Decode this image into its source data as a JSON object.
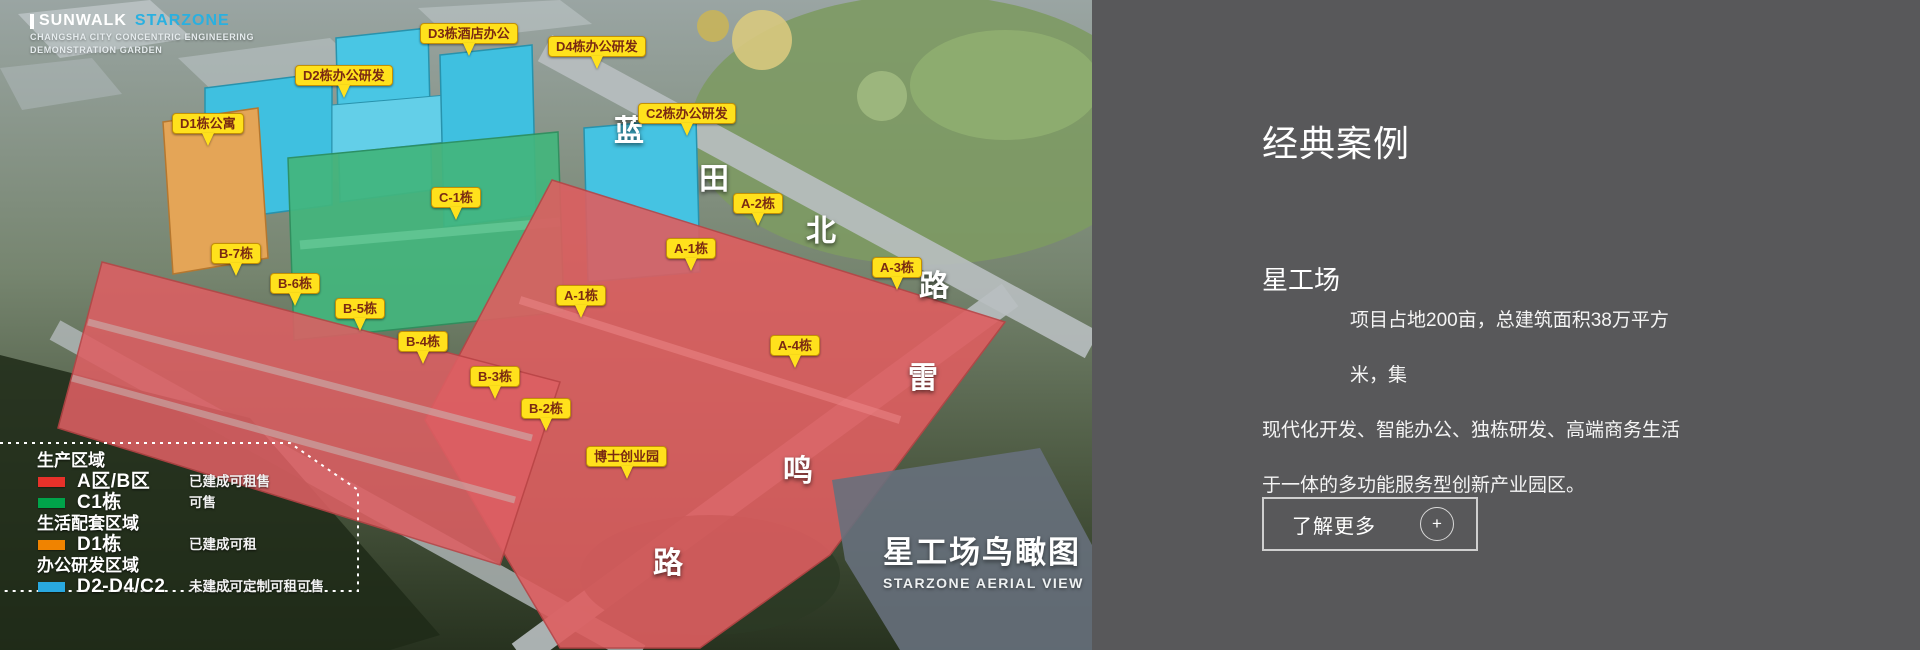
{
  "logo": {
    "brand_primary": "SUNWALK",
    "brand_secondary": "STARZONE",
    "subtitle_line1": "CHANGSHA CITY CONCENTRIC ENGINEERING",
    "subtitle_line2": "DEMONSTRATION GARDEN"
  },
  "aerial": {
    "building_labels": [
      {
        "text": "D1栋公寓"
      },
      {
        "text": "D2栋办公研发"
      },
      {
        "text": "D3栋酒店办公"
      },
      {
        "text": "D4栋办公研发"
      },
      {
        "text": "C2栋办公研发"
      },
      {
        "text": "C-1栋"
      },
      {
        "text": "A-2栋"
      },
      {
        "text": "A-1栋"
      },
      {
        "text": "A-3栋"
      },
      {
        "text": "A-1栋"
      },
      {
        "text": "A-4栋"
      },
      {
        "text": "B-7栋"
      },
      {
        "text": "B-6栋"
      },
      {
        "text": "B-5栋"
      },
      {
        "text": "B-4栋"
      },
      {
        "text": "B-3栋"
      },
      {
        "text": "B-2栋"
      },
      {
        "text": "博士创业园"
      }
    ],
    "road_labels": [
      {
        "text": "蓝"
      },
      {
        "text": "田"
      },
      {
        "text": "北"
      },
      {
        "text": "路"
      },
      {
        "text": "雷"
      },
      {
        "text": "鸣"
      },
      {
        "text": "路"
      }
    ],
    "legend": {
      "groups": [
        {
          "header": "生产区域",
          "items": [
            {
              "swatch": "#e8312a",
              "name": "A区/B区",
              "desc": "已建成可租售"
            },
            {
              "swatch": "#00a34a",
              "name": "C1栋",
              "desc": "可售"
            }
          ]
        },
        {
          "header": "生活配套区域",
          "items": [
            {
              "swatch": "#f08300",
              "name": "D1栋",
              "desc": "已建成可租"
            }
          ]
        },
        {
          "header": "办公研发区域",
          "items": [
            {
              "swatch": "#29a9e0",
              "name": "D2-D4/C2",
              "desc": "未建成可定制可租可售"
            }
          ]
        }
      ]
    },
    "watermark": {
      "title": "星工场鸟瞰图",
      "subtitle": "STARZONE AERIAL VIEW"
    }
  },
  "panel": {
    "section_title": "经典案例",
    "project_title": "星工场",
    "description_lines": [
      "项目占地200亩，总建筑面积38万平方米，集",
      "现代化开发、智能办公、独栋研发、高端商务生活",
      "于一体的多功能服务型创新产业园区。"
    ],
    "more_button": {
      "label": "了解更多",
      "icon": "+"
    }
  },
  "colors": {
    "panel_bg": "#58585a",
    "tag_bg": "#ffe11c",
    "tag_text": "#7a2a12",
    "brand_blue": "#2ab0e0",
    "zone_red": "#de5e60",
    "zone_green": "#43b67d",
    "zone_cyan": "#3fc0e0",
    "zone_orange": "#e4a557"
  }
}
